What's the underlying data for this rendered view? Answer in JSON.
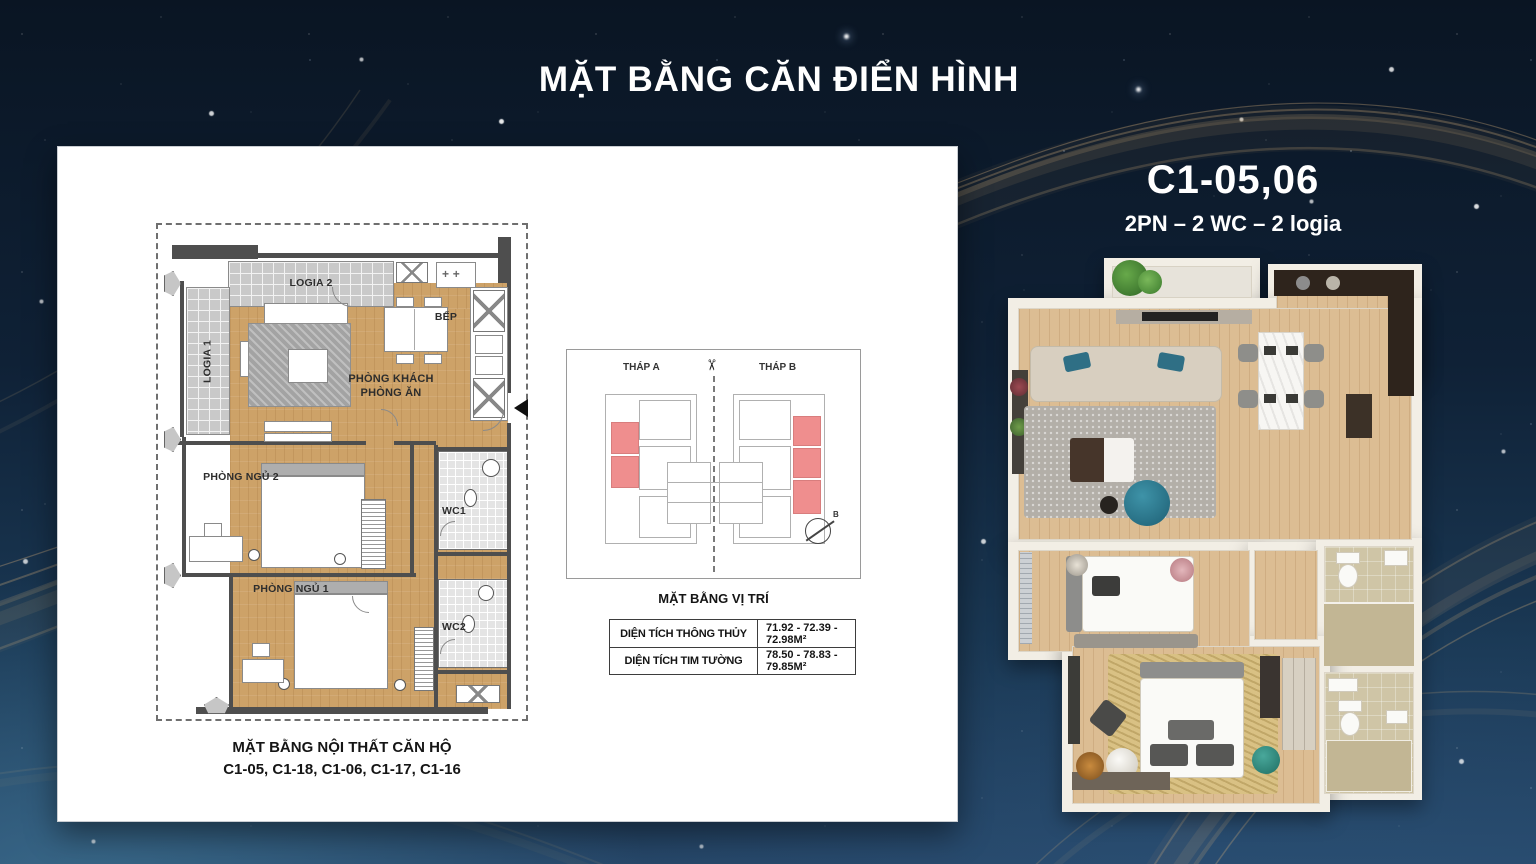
{
  "title": "MẶT BẰNG CĂN ĐIỂN HÌNH",
  "unit": {
    "code": "C1-05,06",
    "spec": "2PN – 2 WC – 2 logia"
  },
  "plan2d": {
    "rooms": {
      "logia2": "LOGIA 2",
      "bep": "BẾP",
      "living1": "PHÒNG KHÁCH",
      "living2": "PHÒNG ĂN",
      "logia1": "LOGIA 1",
      "bedroom2": "PHÒNG NGỦ 2",
      "wc1": "WC1",
      "bedroom1": "PHÒNG NGỦ 1",
      "wc2": "WC2"
    },
    "caption_line1": "MẶT BẰNG NỘI THẤT CĂN HỘ",
    "caption_line2": "C1-05, C1-18, C1-06, C1-17, C1-16"
  },
  "location_plan": {
    "tower_a": "THÁP A",
    "tower_b": "THÁP B",
    "caption": "MẶT BẰNG VỊ TRÍ",
    "compass": "B",
    "highlight_color": "#ef8e8e"
  },
  "area_table": {
    "rows": [
      {
        "label": "DIỆN TÍCH THÔNG THỦY",
        "value": "71.92 - 72.39 - 72.98M²"
      },
      {
        "label": "DIỆN TÍCH TIM TƯỜNG",
        "value": "78.50 - 78.83 - 79.85M²"
      }
    ]
  },
  "colors": {
    "background": "#0f2136",
    "gold_wave": "#d8b07a",
    "panel": "#ffffff",
    "wood": "#cda268"
  }
}
